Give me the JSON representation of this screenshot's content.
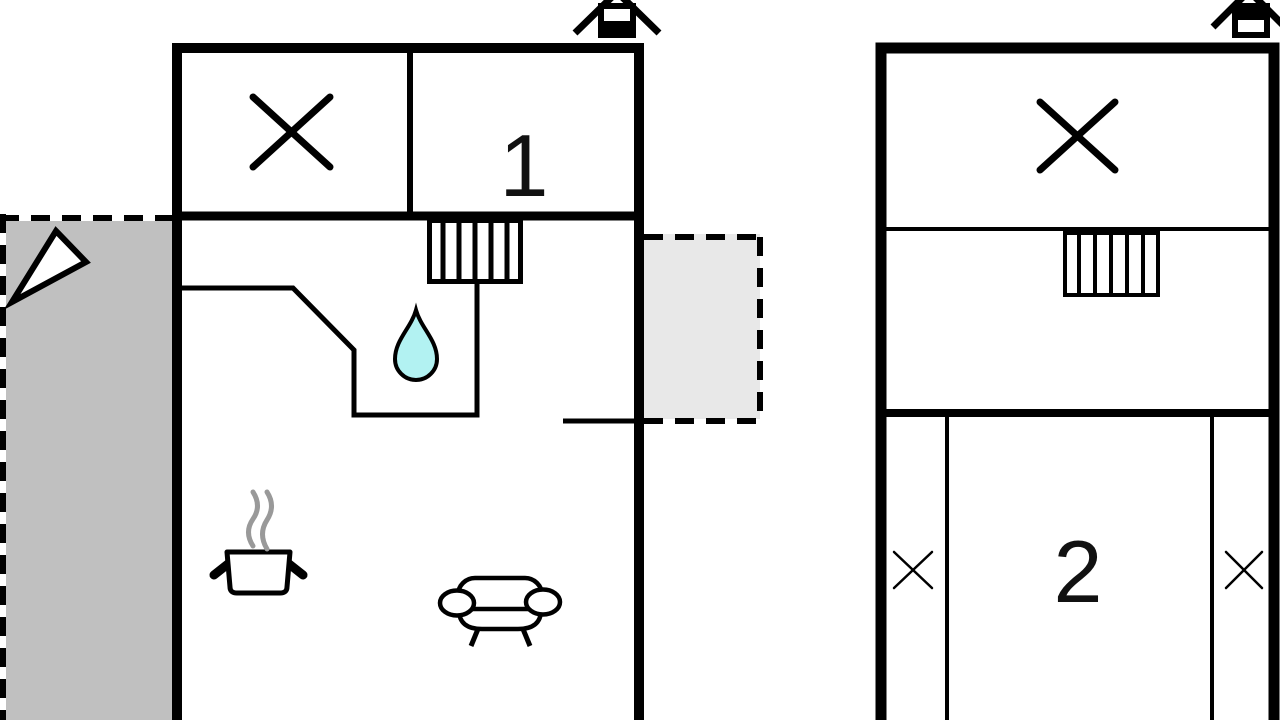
{
  "plan": {
    "ground_floor": {
      "room_number": "1",
      "icons": [
        "chimney-icon",
        "crossed-room-icon",
        "staircase-icon",
        "water-drop-icon",
        "north-arrow-icon",
        "cooking-pot-icon",
        "steam-icon",
        "sofa-icon"
      ],
      "terraces": [
        {
          "position": "left",
          "tone": "dark"
        },
        {
          "position": "right",
          "tone": "light"
        }
      ]
    },
    "upper_floor": {
      "room_number": "2",
      "icons": [
        "chimney-icon",
        "crossed-room-icon",
        "staircase-icon",
        "crossed-closet-left-icon",
        "crossed-closet-right-icon"
      ]
    }
  },
  "colors": {
    "background": "#ffffff",
    "wall": "#000000",
    "terrace_dark": "#c0c0c0",
    "terrace_light": "#e8e8e8",
    "water_drop": "#b2f2f2",
    "steam": "#999999"
  }
}
